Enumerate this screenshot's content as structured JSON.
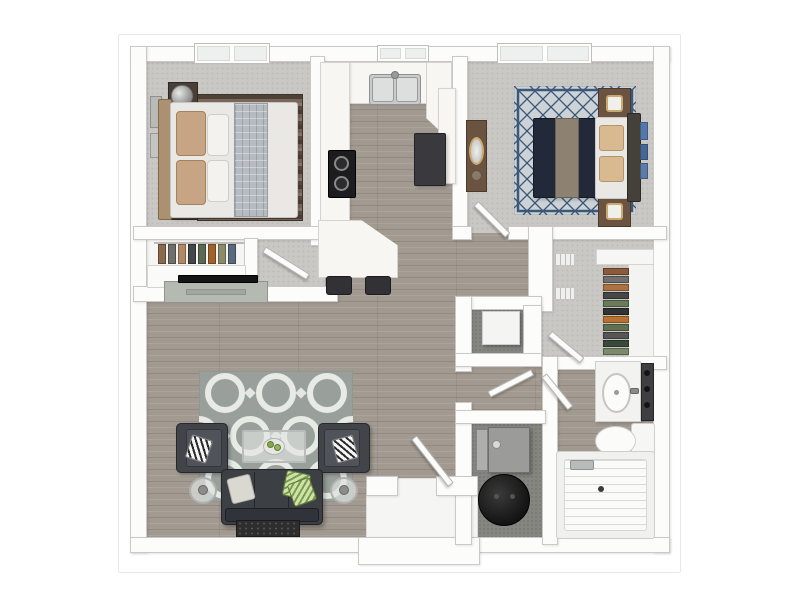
{
  "document": {
    "kind": "3d-apartment-floor-plan-rendering",
    "visible_text": "none",
    "orientation": "top-down"
  },
  "palette": {
    "background": "#ffffff",
    "walls": "#fcfcfb",
    "wood_floor": "#a29a91",
    "carpet": "#c9c8c5",
    "utility_floor": "#868681",
    "sofa_dark": "#3c4045",
    "bed2_navy": "#232b3a",
    "rug1_brown": "#6e5c50",
    "rug_living_gray": "#99a09b",
    "accent_green": "#86a84c",
    "furniture_brown": "#6b5342"
  },
  "rooms": [
    {
      "name": "bedroom-1",
      "floor": "carpet",
      "features": [
        "queen-bed",
        "two-nightstands",
        "lamps",
        "striped-rug",
        "wall-art",
        "window"
      ]
    },
    {
      "name": "bedroom-1-closet",
      "floor": "white",
      "features": [
        "hanging-clothes"
      ]
    },
    {
      "name": "kitchen",
      "floor": "wood",
      "features": [
        "double-sink",
        "stove",
        "refrigerator",
        "u-counter",
        "peninsula",
        "two-bar-stools",
        "window"
      ]
    },
    {
      "name": "bedroom-2",
      "floor": "carpet",
      "features": [
        "queen-bed-navy",
        "two-nightstands",
        "diamond-trellis-rug",
        "dresser-with-mirror",
        "window"
      ]
    },
    {
      "name": "walk-in-closet",
      "floor": "carpet",
      "features": [
        "hanging-clothes",
        "wire-shelves",
        "wardrobe-panel"
      ]
    },
    {
      "name": "hall-closet",
      "floor": "dark",
      "features": [
        "storage-box"
      ]
    },
    {
      "name": "living-room",
      "floor": "wood",
      "features": [
        "sofa",
        "two-armchairs",
        "glass-coffee-table",
        "quatrefoil-rug",
        "tv-console",
        "side-tables",
        "door-mat"
      ]
    },
    {
      "name": "bathroom",
      "floor": "wood",
      "features": [
        "vanity-sink",
        "mirror",
        "toilet",
        "bathtub"
      ]
    },
    {
      "name": "laundry-utility",
      "floor": "dark",
      "features": [
        "washer",
        "water-heater"
      ]
    },
    {
      "name": "entry",
      "floor": "white",
      "features": [
        "front-door",
        "alcove"
      ]
    }
  ],
  "doors": [
    "bedroom-1-door",
    "bedroom-2-door",
    "walk-in-closet-door",
    "hall-closet-door",
    "bathroom-door",
    "front-door"
  ],
  "windows": [
    "bedroom-1-window",
    "kitchen-window",
    "bedroom-2-window"
  ]
}
